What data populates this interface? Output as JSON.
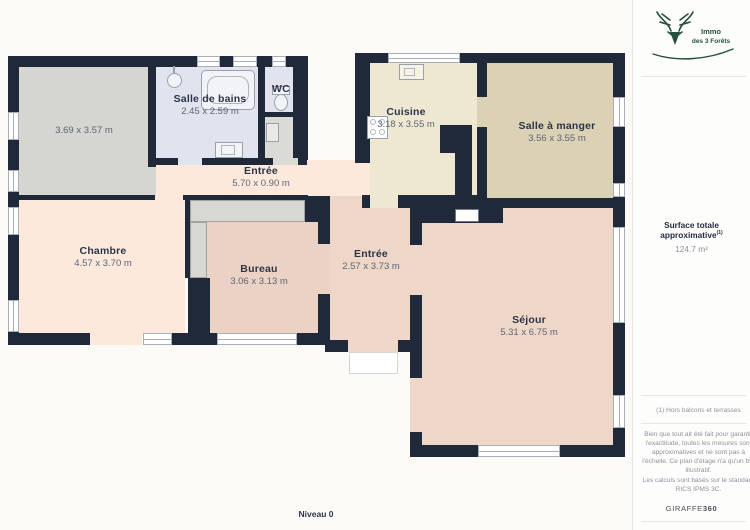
{
  "plan": {
    "level_label": "Niveau 0",
    "rooms": [
      {
        "name": "",
        "dims": "3.69 x 3.57 m"
      },
      {
        "name": "Salle de bains",
        "dims": "2.45 x 2.59 m"
      },
      {
        "name": "WC",
        "dims": ""
      },
      {
        "name": "Cuisine",
        "dims": "3.18 x 3.55 m"
      },
      {
        "name": "Salle à manger",
        "dims": "3.56 x 3.55 m"
      },
      {
        "name": "Entrée",
        "dims": "5.70 x 0.90 m"
      },
      {
        "name": "Chambre",
        "dims": "4.57 x 3.70 m"
      },
      {
        "name": "Bureau",
        "dims": "3.06 x 3.13 m"
      },
      {
        "name": "Entrée",
        "dims": "2.57 x 3.73 m"
      },
      {
        "name": "Séjour",
        "dims": "5.31 x 6.75 m"
      }
    ],
    "colors": {
      "wall": "#1f2939",
      "floor_peach_light": "#fce9dc",
      "floor_peach_dark": "#eed6c9",
      "floor_cream": "#eee7d2",
      "floor_khaki": "#dbd1b4",
      "floor_blue": "#e1e4ee",
      "floor_gray": "#d5d5d1",
      "door_arc": "#a78b6e"
    }
  },
  "sidebar": {
    "logo": {
      "line1": "Immo",
      "line2": "des 3 Forêts",
      "color": "#26503e"
    },
    "surface_label": "Surface totale approximative",
    "surface_sup": "(1)",
    "surface_value": "124.7 m²",
    "footnote": "(1) Hors balcons et terrasses",
    "disclaimer": "Bien que tout ait été fait pour garantir l'exactitude, toutes les mesures sont approximatives et ne sont pas à l'échelle. Ce plan d'étage n'a qu'un but illustratif.",
    "standard": "Les calculs sont basés sur le standard RICS IPMS 3C.",
    "brand_name": "GIRAFFE",
    "brand_suffix": "360"
  }
}
